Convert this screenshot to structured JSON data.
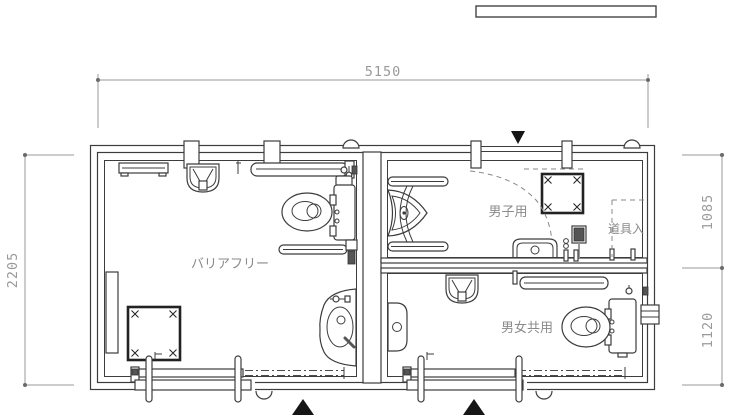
{
  "colors": {
    "line": "#3c3c3c",
    "dimension": "#9a9a9a",
    "label": "#8a8a8a"
  },
  "dimensions": {
    "width_total": "5150",
    "height_total": "2205",
    "height_mens": "1085",
    "height_unisex": "1120"
  },
  "rooms": {
    "barrier_free": "バリアフリー",
    "mens": "男子用",
    "tool_storage": "道具入",
    "unisex": "男女共用"
  }
}
